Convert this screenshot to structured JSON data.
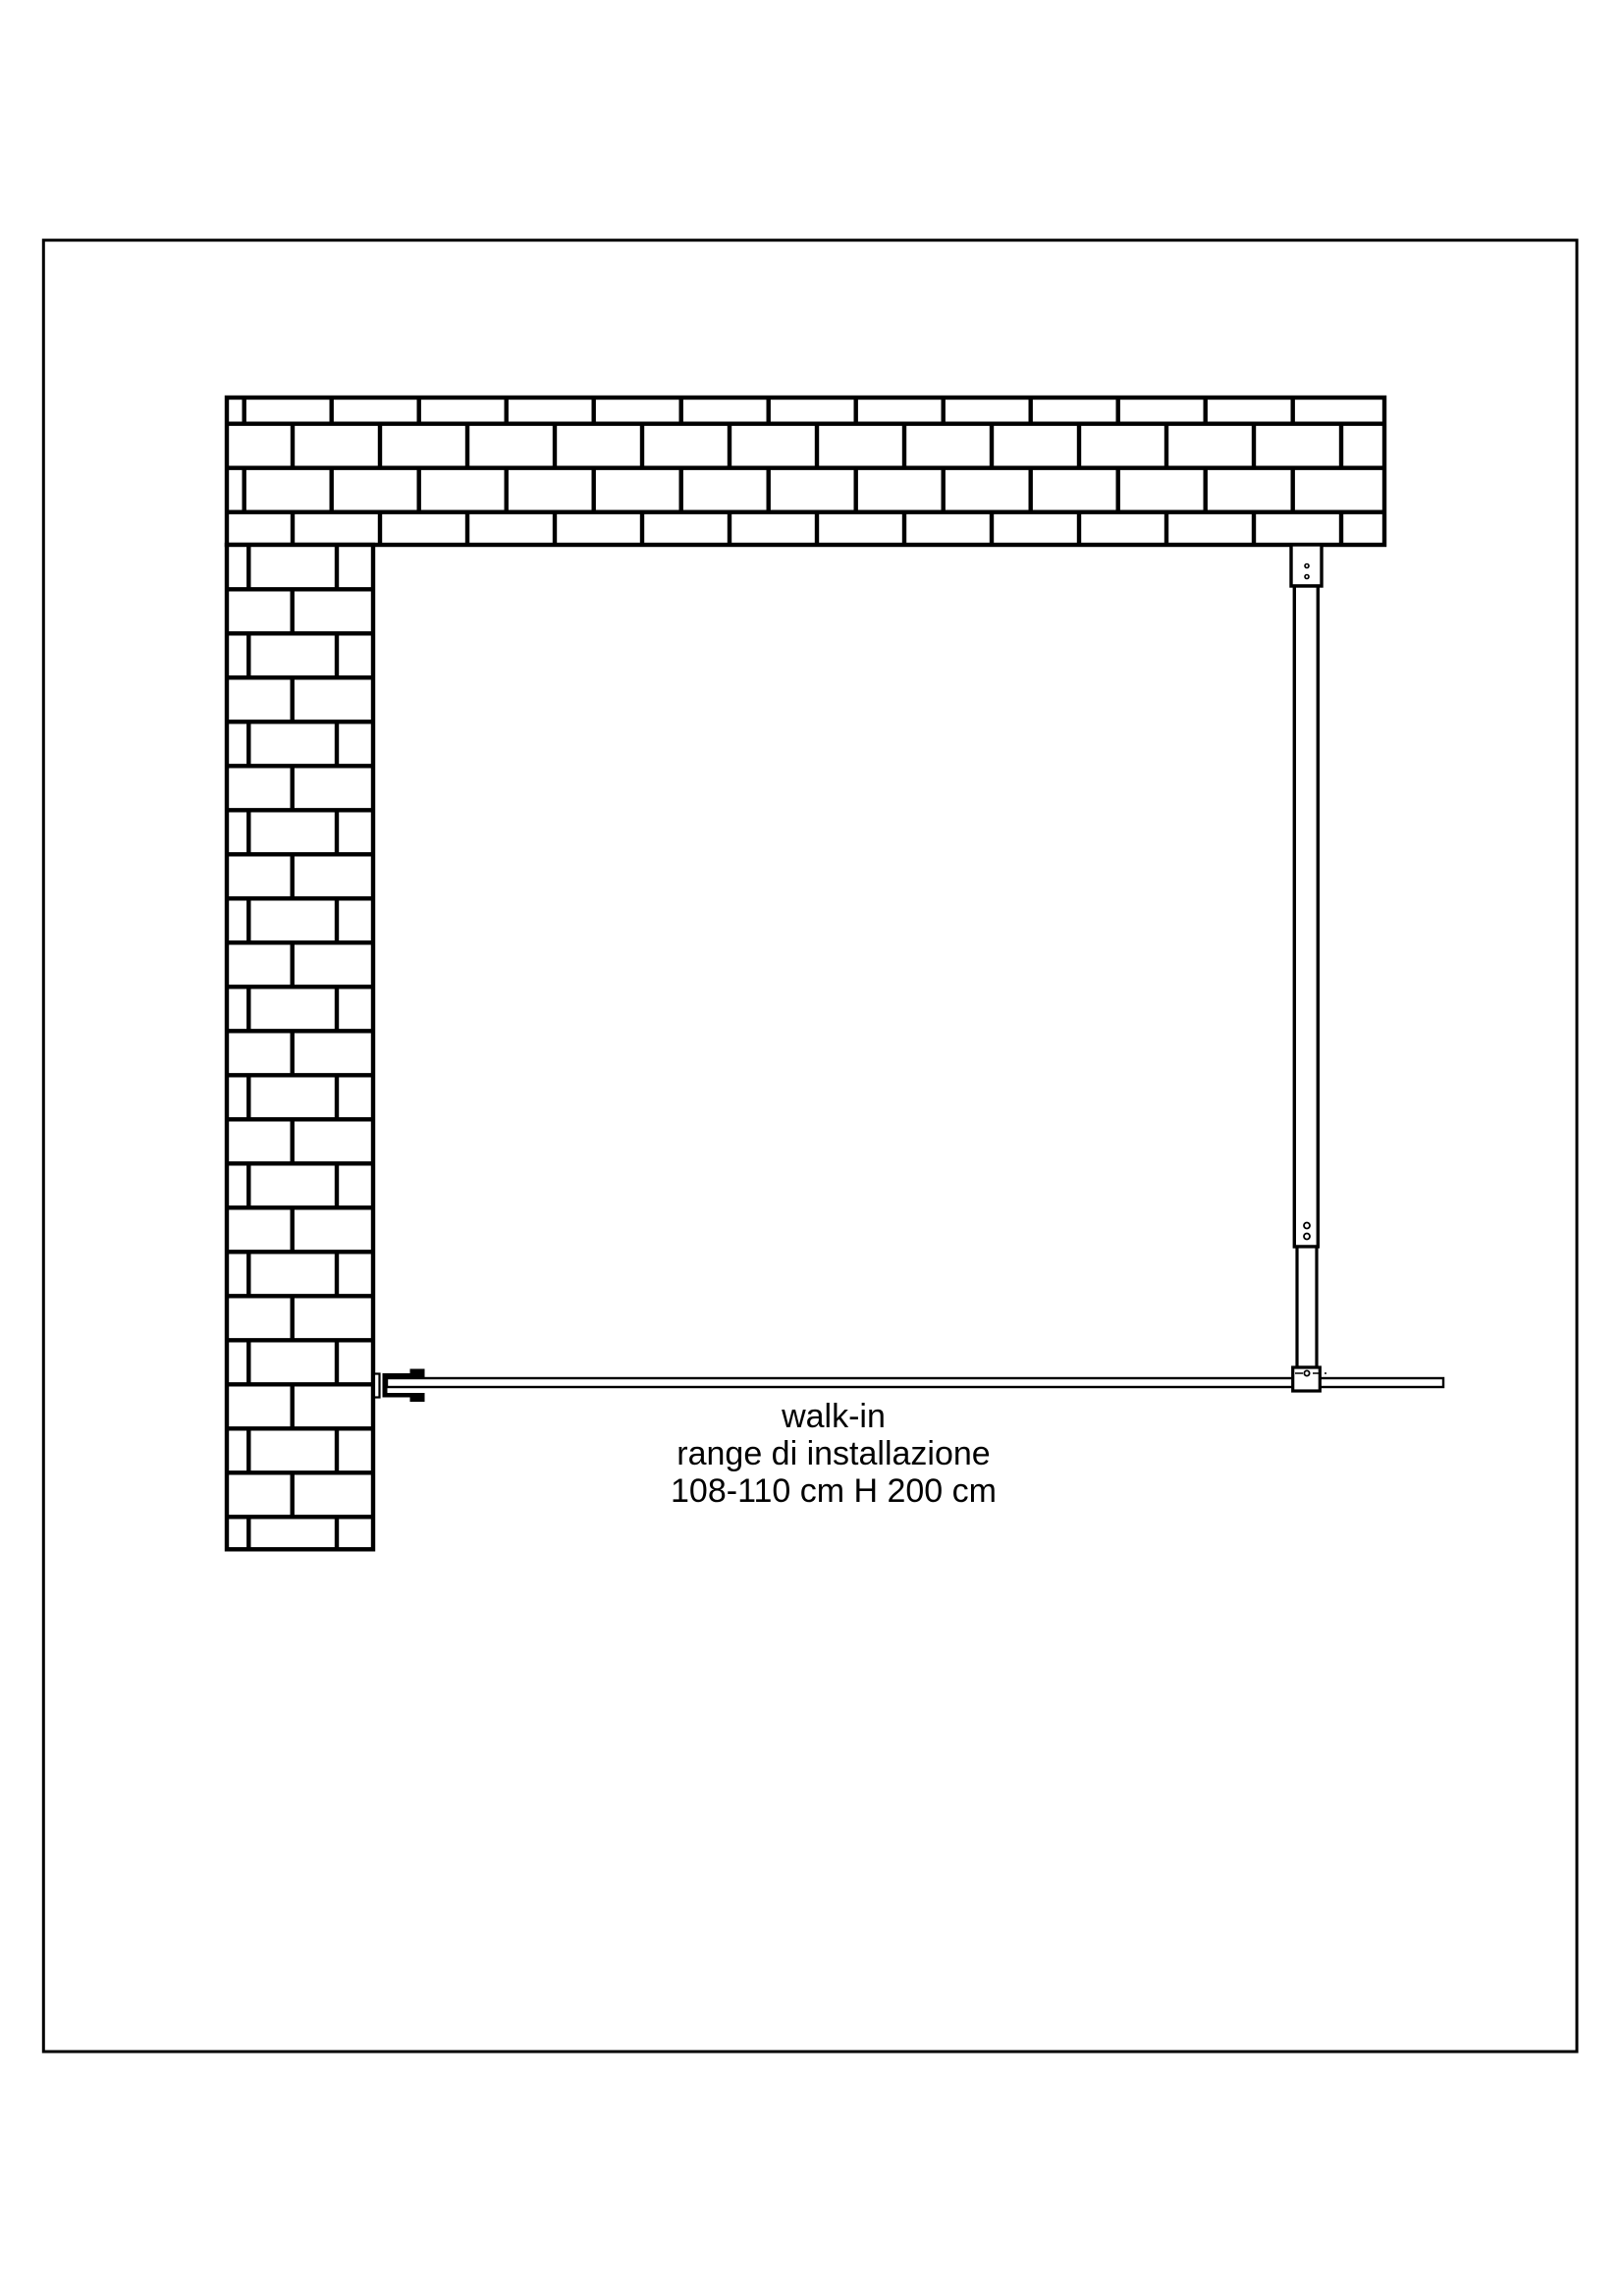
{
  "colors": {
    "background": "#ffffff",
    "line": "#000000"
  },
  "annotation": {
    "product": "walk-in",
    "range": "range di installazione",
    "dimensions": "108-110 cm H 200 cm"
  }
}
